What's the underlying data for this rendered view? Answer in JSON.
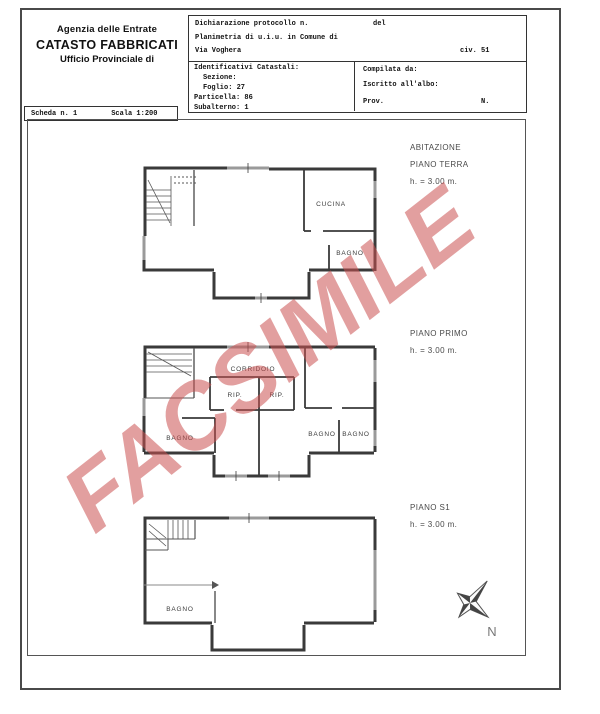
{
  "header": {
    "agency": {
      "line1": "Agenzia delle Entrate",
      "line2": "CATASTO FABBRICATI",
      "line3": "Ufficio Provinciale di"
    },
    "scheda": {
      "scheda_label": "Scheda n. 1",
      "scala_label": "Scala 1:200"
    },
    "declaration": {
      "protocollo_label": "Dichiarazione protocollo n.",
      "del_label": "del",
      "planimetria_label": "Planimetria di u.i.u. in Comune di",
      "street": "Via Voghera",
      "civic": "civ. 51"
    },
    "catastali": {
      "title": "Identificativi Catastali:",
      "sezione": "Sezione:",
      "foglio": "Foglio: 27",
      "particella": "Particella: 86",
      "subalterno": "Subalterno: 1"
    },
    "compiler": {
      "compilata": "Compilata da:",
      "iscritto": "Iscritto all'albo:",
      "prov": "Prov.",
      "n": "N."
    }
  },
  "plans": {
    "terra": {
      "title1": "ABITAZIONE",
      "title2": "PIANO TERRA",
      "height": "h. = 3.00 m.",
      "rooms": {
        "cucina": "CUCINA",
        "bagno": "BAGNO"
      }
    },
    "primo": {
      "title2": "PIANO PRIMO",
      "height": "h. = 3.00 m.",
      "rooms": {
        "corridoio": "CORRIDOIO",
        "rip1": "RIP.",
        "rip2": "RIP.",
        "bagno1": "BAGNO",
        "bagno2": "BAGNO",
        "bagno3": "BAGNO"
      }
    },
    "s1": {
      "title2": "PIANO S1",
      "height": "h. = 3.00 m.",
      "rooms": {
        "bagno": "BAGNO"
      }
    }
  },
  "compass": {
    "north_label": "N"
  },
  "watermark": {
    "text": "FACSIMILE",
    "color": "#ca5050",
    "opacity": "0.55"
  },
  "colors": {
    "wall": "#3a3a3a",
    "window": "#9a9a9a",
    "border": "#4a4a4a",
    "label": "#3c3c3c"
  }
}
